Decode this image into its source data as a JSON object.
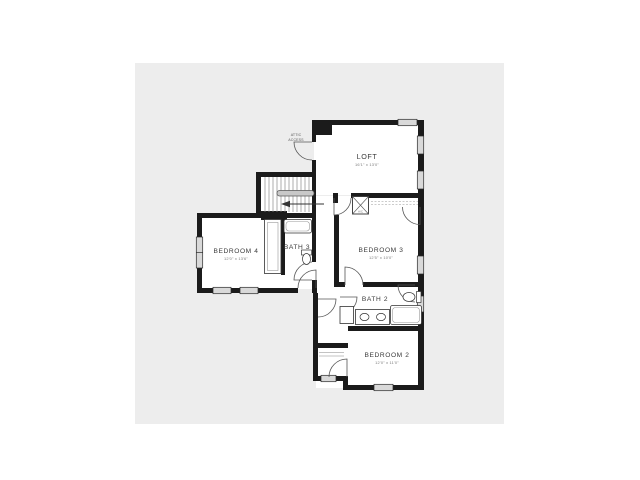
{
  "colors": {
    "page_bg": "#ffffff",
    "panel_bg": "#ededed",
    "wall": "#1b1b1b",
    "window_fill": "#d9d9d9",
    "room_fill": "#ffffff",
    "fixture_stroke": "#333333",
    "handrail_fill": "#c8c8c8"
  },
  "plan": {
    "rooms": {
      "loft": {
        "label": "LOFT",
        "dims": "16'1\" x 13'0\""
      },
      "bedroom4": {
        "label": "BEDROOM 4",
        "dims": "12'0\" x 13'6\""
      },
      "bath3": {
        "label": "BATH 3"
      },
      "bedroom3": {
        "label": "BEDROOM 3",
        "dims": "12'5\" x 10'0\""
      },
      "bath2": {
        "label": "BATH 2"
      },
      "bedroom2": {
        "label": "BEDROOM 2",
        "dims": "12'0\" x 11'0\""
      }
    },
    "annotations": {
      "attic_line1": "ATTIC",
      "attic_line2": "ACCESS",
      "ac_closet": "A/C"
    }
  }
}
